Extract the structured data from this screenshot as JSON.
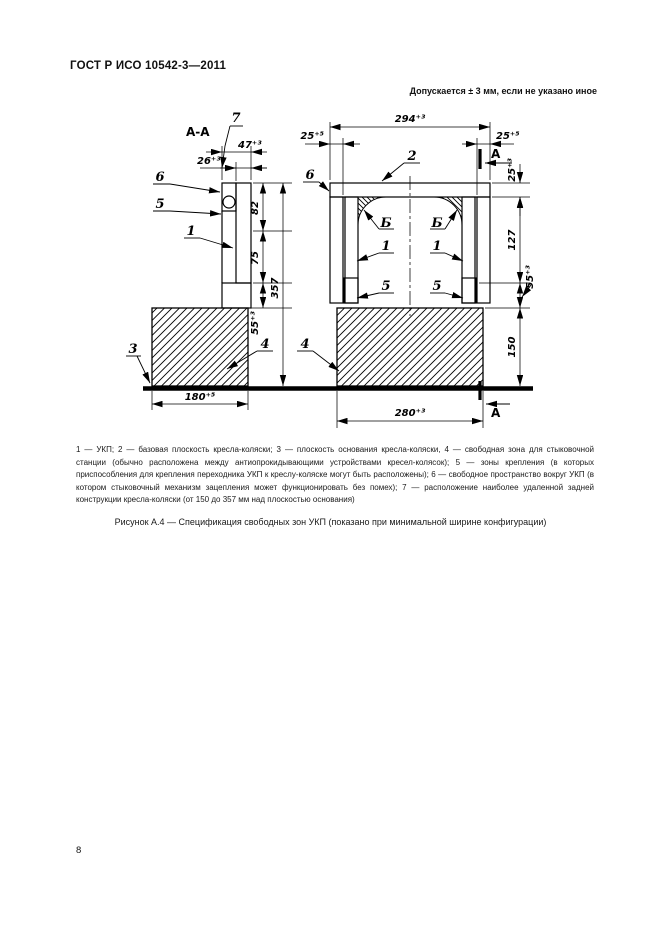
{
  "page": {
    "header_title": "ГОСТ Р ИСО 10542-3—2011",
    "page_number": "8"
  },
  "drawing": {
    "tolerance_note": "Допускается ± 3 мм, если не указано иное",
    "section_view_label": "А-А",
    "section_cut_label": "А",
    "labels": {
      "n1": "1",
      "n2": "2",
      "n3": "3",
      "n4": "4",
      "n5": "5",
      "n6": "6",
      "n7": "7",
      "zone_b": "Б"
    },
    "dims": {
      "d294": "294⁺³",
      "d25l": "25⁺⁵",
      "d25r": "25⁺⁵",
      "d25t": "25⁺³",
      "d47": "47⁺³",
      "d26": "26⁺³",
      "d82": "82",
      "d75": "75",
      "d55": "55⁺³",
      "d357": "357",
      "d127": "127",
      "d150": "150",
      "d180": "180⁺⁵",
      "d280": "280⁺³"
    }
  },
  "caption": {
    "legend": "1 — УКП; 2 — базовая плоскость кресла-коляски; 3 — плоскость основания кресла-коляски, 4 — свободная зона для стыковочной станции (обычно расположена между антиопрокидывающими устройствами кресел-колясок); 5 — зоны крепления (в которых приспособления для крепления переходника УКП к креслу-коляске могут быть расположены); 6 — свободное пространство вокруг УКП (в котором стыковочный механизм зацепления может функционировать без помех); 7 — расположение наиболее удаленной задней конструкции кресла-коляски (от 150 до 357 мм над плоскостью основания)",
    "figure_title": "Рисунок А.4 — Спецификация свободных зон УКП (показано при минимальной ширине конфигурации)"
  }
}
